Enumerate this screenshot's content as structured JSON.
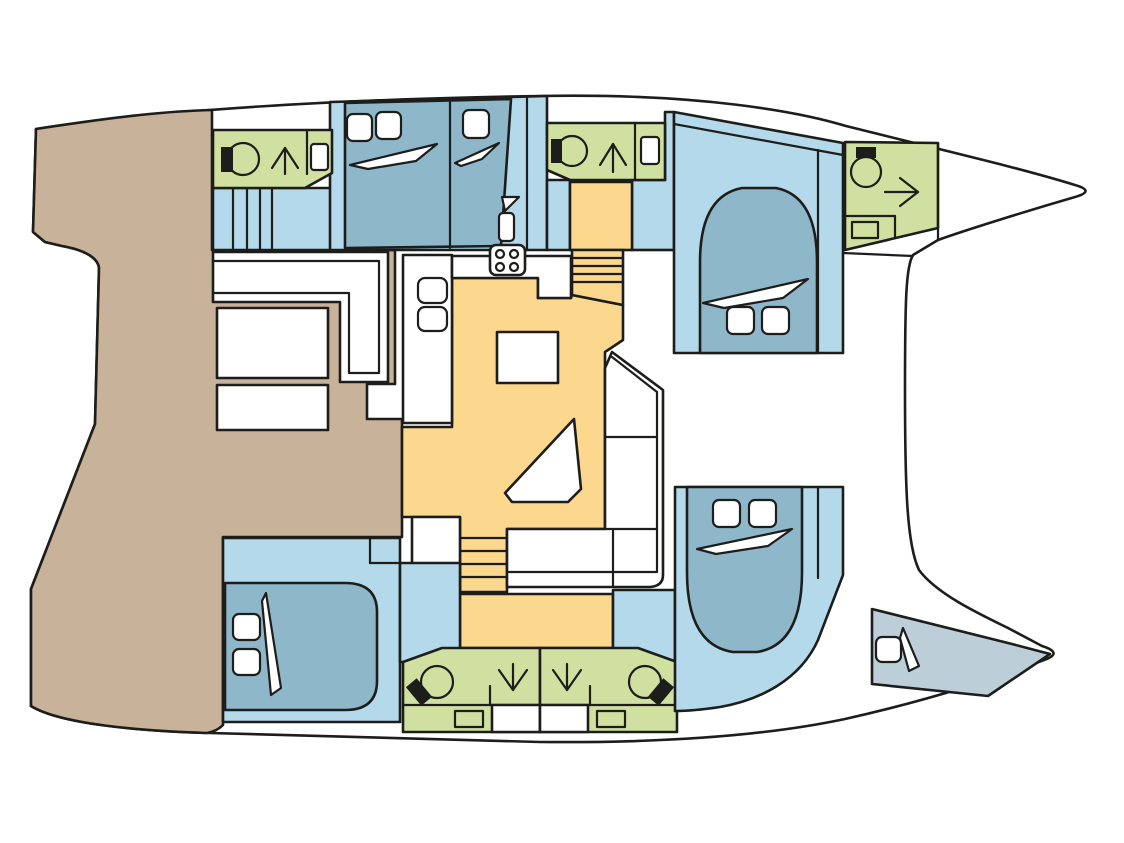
{
  "diagram": {
    "type": "floor-plan",
    "subject": "Catamaran yacht interior layout, top view, bows pointing right",
    "colors": {
      "line": "#1d1d1b",
      "deck": "#c8b29a",
      "cabin_floor": "#b3d9ea",
      "berth": "#8eb7ca",
      "bathroom": "#d0e0a0",
      "salon_floor": "#fbd88d",
      "crew_area": "#bccfd8",
      "furniture": "#ffffff"
    },
    "areas": [
      {
        "id": "aft-deck",
        "label": "Aft deck / cockpit",
        "color_key": "deck",
        "fixtures": [
          "l-shaped-bench",
          "cockpit-table",
          "bench"
        ]
      },
      {
        "id": "port-aft-bathroom",
        "label": "Port aft bathroom",
        "color_key": "bathroom",
        "fixtures": [
          "toilet",
          "shower-arrow-up",
          "sink"
        ]
      },
      {
        "id": "port-companionway",
        "label": "Port companionway steps",
        "color_key": "cabin_floor",
        "fixtures": [
          "stairs-4-treads"
        ]
      },
      {
        "id": "port-aft-cabin",
        "label": "Port aft cabin",
        "color_key": "cabin_floor",
        "fixtures": [
          "double-berth",
          "pillow",
          "pillow",
          "single-berth",
          "pillow",
          "door-leaf",
          "stool"
        ]
      },
      {
        "id": "port-mid-bathroom",
        "label": "Port mid bathroom",
        "color_key": "bathroom",
        "fixtures": [
          "toilet",
          "shower-arrow-up",
          "sink"
        ]
      },
      {
        "id": "port-forward-cabin",
        "label": "Port forward cabin",
        "color_key": "cabin_floor",
        "fixtures": [
          "double-berth",
          "pillow",
          "pillow"
        ]
      },
      {
        "id": "port-bow-bathroom",
        "label": "Port bow bathroom",
        "color_key": "bathroom",
        "fixtures": [
          "toilet",
          "shower-arrow-right",
          "sink"
        ]
      },
      {
        "id": "salon-galley",
        "label": "Salon and galley",
        "color_key": "salon_floor",
        "fixtures": [
          "galley-counter",
          "sink",
          "sink",
          "stove-4-burner",
          "square-table",
          "chart-seat",
          "l-shaped-sofa",
          "stairs-to-port-hull",
          "stairs-to-starboard-hull",
          "entry-door-gap"
        ]
      },
      {
        "id": "starboard-aft-cabin",
        "label": "Starboard aft cabin",
        "color_key": "cabin_floor",
        "fixtures": [
          "double-berth",
          "pillow",
          "pillow"
        ]
      },
      {
        "id": "starboard-aft-bathroom",
        "label": "Starboard bathroom (aft of pair)",
        "color_key": "bathroom",
        "fixtures": [
          "toilet",
          "shower-arrow-down",
          "sink"
        ]
      },
      {
        "id": "starboard-forward-bathroom",
        "label": "Starboard bathroom (forward of pair)",
        "color_key": "bathroom",
        "fixtures": [
          "shower-arrow-down",
          "toilet",
          "sink"
        ]
      },
      {
        "id": "starboard-forward-cabin",
        "label": "Starboard forward cabin",
        "color_key": "cabin_floor",
        "fixtures": [
          "double-berth",
          "pillow",
          "pillow"
        ]
      },
      {
        "id": "starboard-bow-compartment",
        "label": "Starboard bow compartment (crew/storage berth)",
        "color_key": "crew_area",
        "fixtures": [
          "berth",
          "pillow",
          "mattress-fold"
        ]
      },
      {
        "id": "foredeck",
        "label": "Foredeck / trampoline area between bows",
        "color_key": "furniture",
        "fixtures": []
      }
    ],
    "fixture_glyphs": {
      "toilet": "circle bowl with black tank block",
      "shower": "long arrow showing walk-in direction",
      "sink": "small rounded rectangle",
      "stove": "rounded rectangle with 4 burner circles",
      "pillow": "small rounded white square at berth head",
      "mattress-fold": "thin white sliver triangle on berth",
      "stairs": "band of parallel lines"
    }
  }
}
